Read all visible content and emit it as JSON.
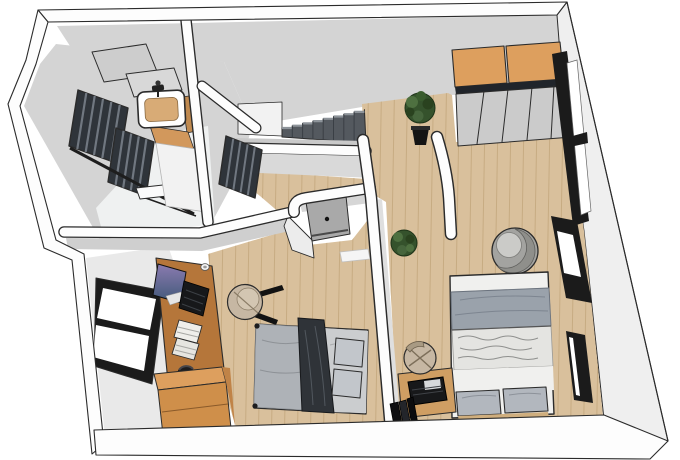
{
  "scene": {
    "type": "3d-floorplan-cutaway-render",
    "rooms": [
      {
        "name": "bathroom",
        "items": [
          "sink",
          "faucet",
          "wood-counter",
          "louver-window",
          "louver-window",
          "louver-window",
          "glass-panel",
          "glass-panel",
          "shelf",
          "glass-partition"
        ]
      },
      {
        "name": "stair-landing",
        "items": [
          "staircase",
          "railing-wall",
          "potted-plant"
        ]
      },
      {
        "name": "hallway",
        "items": [
          "open-door",
          "rounded-corner-walls",
          "floor-mat"
        ]
      },
      {
        "name": "bedroom-left",
        "items": [
          "desk",
          "monitor",
          "keyboard",
          "mug",
          "books",
          "headphones",
          "window",
          "stool",
          "single-bed",
          "dark-throw",
          "pillows",
          "dresser"
        ]
      },
      {
        "name": "bedroom-right",
        "items": [
          "wardrobe-cabinets",
          "sliding-doors",
          "corner-window",
          "wall-window",
          "wall-window",
          "double-bed",
          "pillows",
          "armchair",
          "stool",
          "laptop-desk",
          "laptop",
          "books",
          "plant"
        ]
      }
    ]
  },
  "colors": {
    "background": "#ffffff",
    "outline": "#2b2b2b",
    "wall_top": "#fdfdfd",
    "wall_face": "#d4d4d4",
    "wall_face_light": "#e9e9e9",
    "right_wall_face": "#efefef",
    "floor_wood": "#d9c09c",
    "floor_wood_line": "#c5a97f",
    "bathroom_floor": "#eff1f1",
    "cabinet_orange": "#dd9f5e",
    "cabinet_orange_dark": "#c08347",
    "dresser_front": "#cf8f4a",
    "desk_wood": "#b5763a",
    "nightstand_wood": "#cf9e63",
    "window_black": "#1b1b1b",
    "louver_dark": "#2f343a",
    "louver_slat": "#707780",
    "stair_dark": "#54595f",
    "stair_light": "#8e949a",
    "railing_gray": "#c9c9c9",
    "door_leaf": "#a9a9a9",
    "sliding_panel": "#cbcbcb",
    "duvet_gray": "#9aa2ab",
    "bed_white": "#f0f0ee",
    "bed_texture": "#e4e4e1",
    "pillow_gray": "#b2b7be",
    "single_bed_gray": "#aeb2b7",
    "single_bed_base": "#d3d4d5",
    "throw_dark": "#2f3338",
    "chair_tan": "#c6b7a3",
    "chair_tan_dark": "#94866f",
    "armchair_gray": "#a3a3a0",
    "armchair_seat": "#cbcbc8",
    "armchair_band": "#8f8f8b",
    "plant_green": "#35522c",
    "plant_green_light": "#4e7040",
    "plant_green_dark": "#2a421f",
    "pot_black": "#141414",
    "monitor_grad_top": "#8b7bb0",
    "monitor_grad_bottom": "#3f5878",
    "device_black": "#17181a",
    "sink_basin": "#d8ab76",
    "counter_side": "#c08a50",
    "counter_front": "#d2985c"
  }
}
